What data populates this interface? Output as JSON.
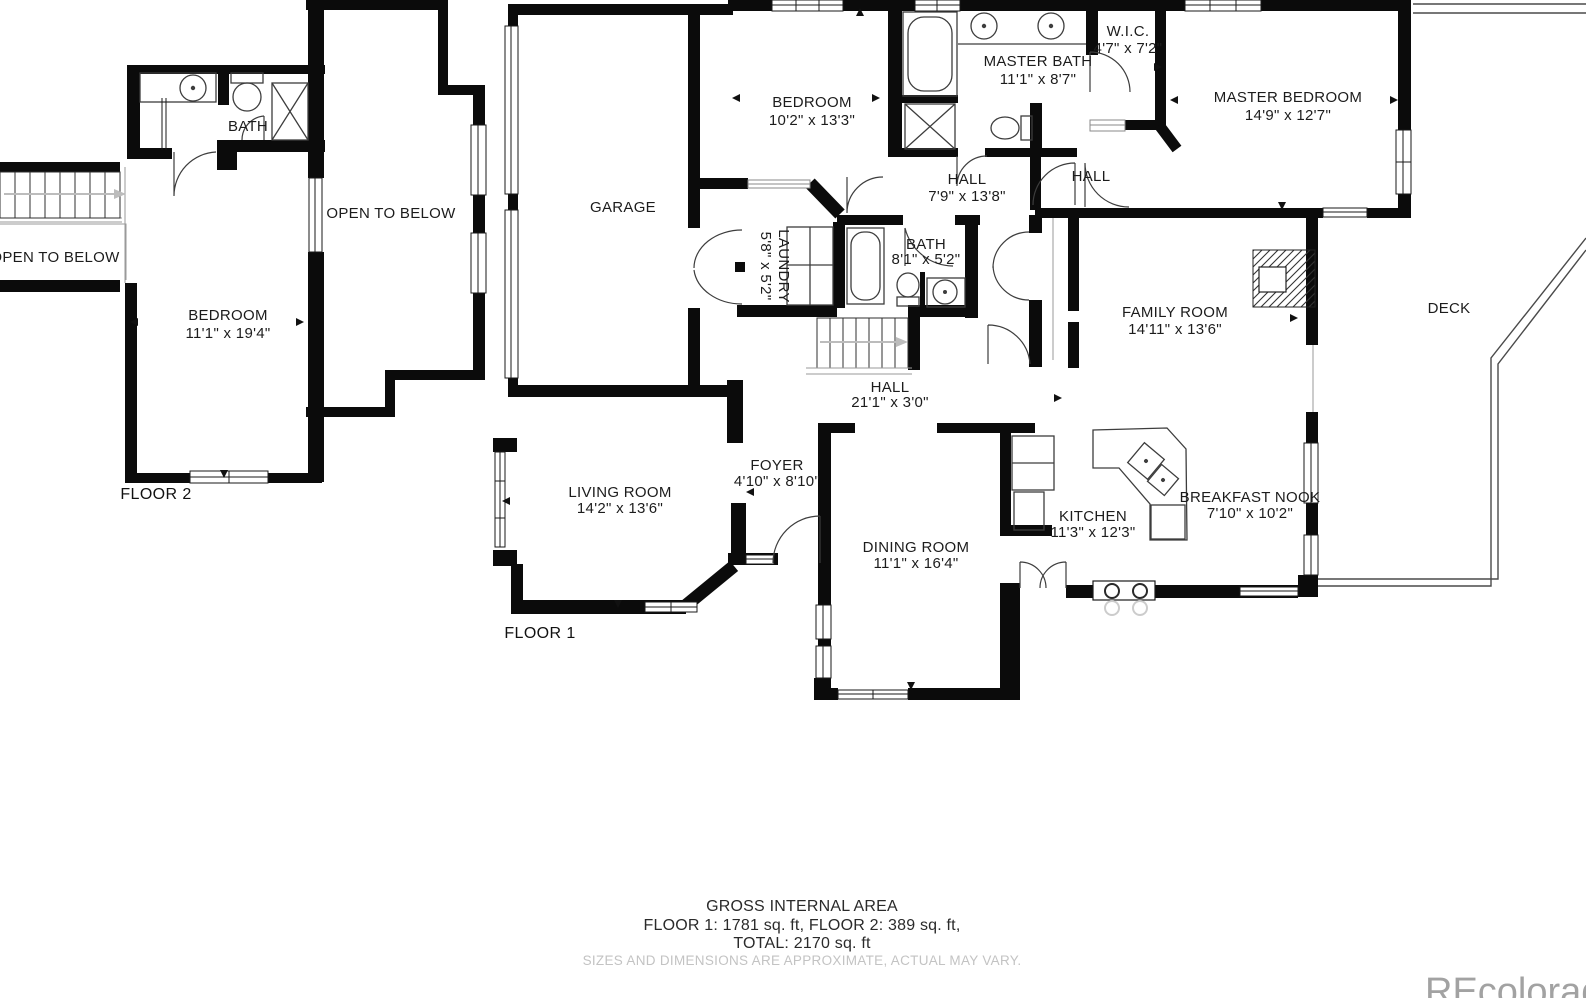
{
  "floor2": {
    "label": "FLOOR 2",
    "bath": "BATH",
    "bedroom": {
      "name": "BEDROOM",
      "dims": "11'1\" x 19'4\""
    },
    "open_to_below_left": "OPEN TO BELOW",
    "open_to_below_right": "OPEN TO BELOW"
  },
  "floor1": {
    "label": "FLOOR 1",
    "garage": "GARAGE",
    "bedroom": {
      "name": "BEDROOM",
      "dims": "10'2\" x 13'3\""
    },
    "master_bath": {
      "name": "MASTER BATH",
      "dims": "11'1\" x 8'7\""
    },
    "wic": {
      "name": "W.I.C.",
      "dims": "4'7\" x 7'2\""
    },
    "master_bedroom": {
      "name": "MASTER BEDROOM",
      "dims": "14'9\" x 12'7\""
    },
    "hall_upper": {
      "name": "HALL",
      "dims": "7'9\" x 13'8\""
    },
    "hall_small": "HALL",
    "bath": {
      "name": "BATH",
      "dims": "8'1\" x 5'2\""
    },
    "laundry": {
      "name": "LAUNDRY",
      "dims": "5'8\" x 5'2\""
    },
    "hall_long": {
      "name": "HALL",
      "dims": "21'1\" x 3'0\""
    },
    "family_room": {
      "name": "FAMILY ROOM",
      "dims": "14'11\" x 13'6\""
    },
    "deck": "DECK",
    "living_room": {
      "name": "LIVING ROOM",
      "dims": "14'2\" x 13'6\""
    },
    "foyer": {
      "name": "FOYER",
      "dims": "4'10\" x 8'10\""
    },
    "dining_room": {
      "name": "DINING ROOM",
      "dims": "11'1\" x 16'4\""
    },
    "kitchen": {
      "name": "KITCHEN",
      "dims": "11'3\" x 12'3\""
    },
    "breakfast_nook": {
      "name": "BREAKFAST NOOK",
      "dims": "7'10\" x 10'2\""
    }
  },
  "footer": {
    "title": "GROSS INTERNAL AREA",
    "areas": "FLOOR 1: 1781 sq. ft, FLOOR 2: 389 sq. ft,",
    "total": "TOTAL: 2170 sq. ft",
    "disclaimer": "SIZES AND DIMENSIONS ARE APPROXIMATE, ACTUAL MAY VARY."
  },
  "watermark": "REcolorado"
}
